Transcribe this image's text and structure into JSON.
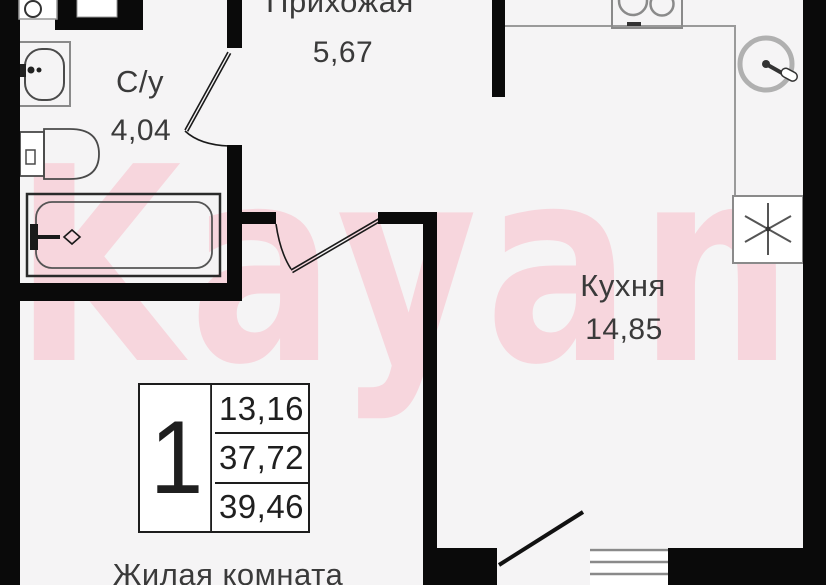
{
  "plan": {
    "watermark": "Kayan",
    "rooms": [
      {
        "name": "Прихожая",
        "area": "5,67"
      },
      {
        "name": "С/у",
        "area": "4,04"
      },
      {
        "name": "Кухня",
        "area": "14,85"
      },
      {
        "name": "Жилая комната"
      }
    ],
    "legend": {
      "rooms_count": "1",
      "values": [
        "13,16",
        "37,72",
        "39,46"
      ]
    },
    "fixtures": [
      "washing-machine-icon",
      "bathroom-sink-icon",
      "toilet-icon",
      "bathtub-icon",
      "stove-icon",
      "kitchen-sink-icon",
      "refrigerator-marker-icon",
      "window-icon",
      "door-swing-icon"
    ],
    "colors": {
      "wall": "#0a0a0a",
      "floor": "#f5f4f5",
      "thin_line": "#8f8f8f",
      "text": "#3a3a3a",
      "watermark": "#f7d6dd"
    }
  }
}
